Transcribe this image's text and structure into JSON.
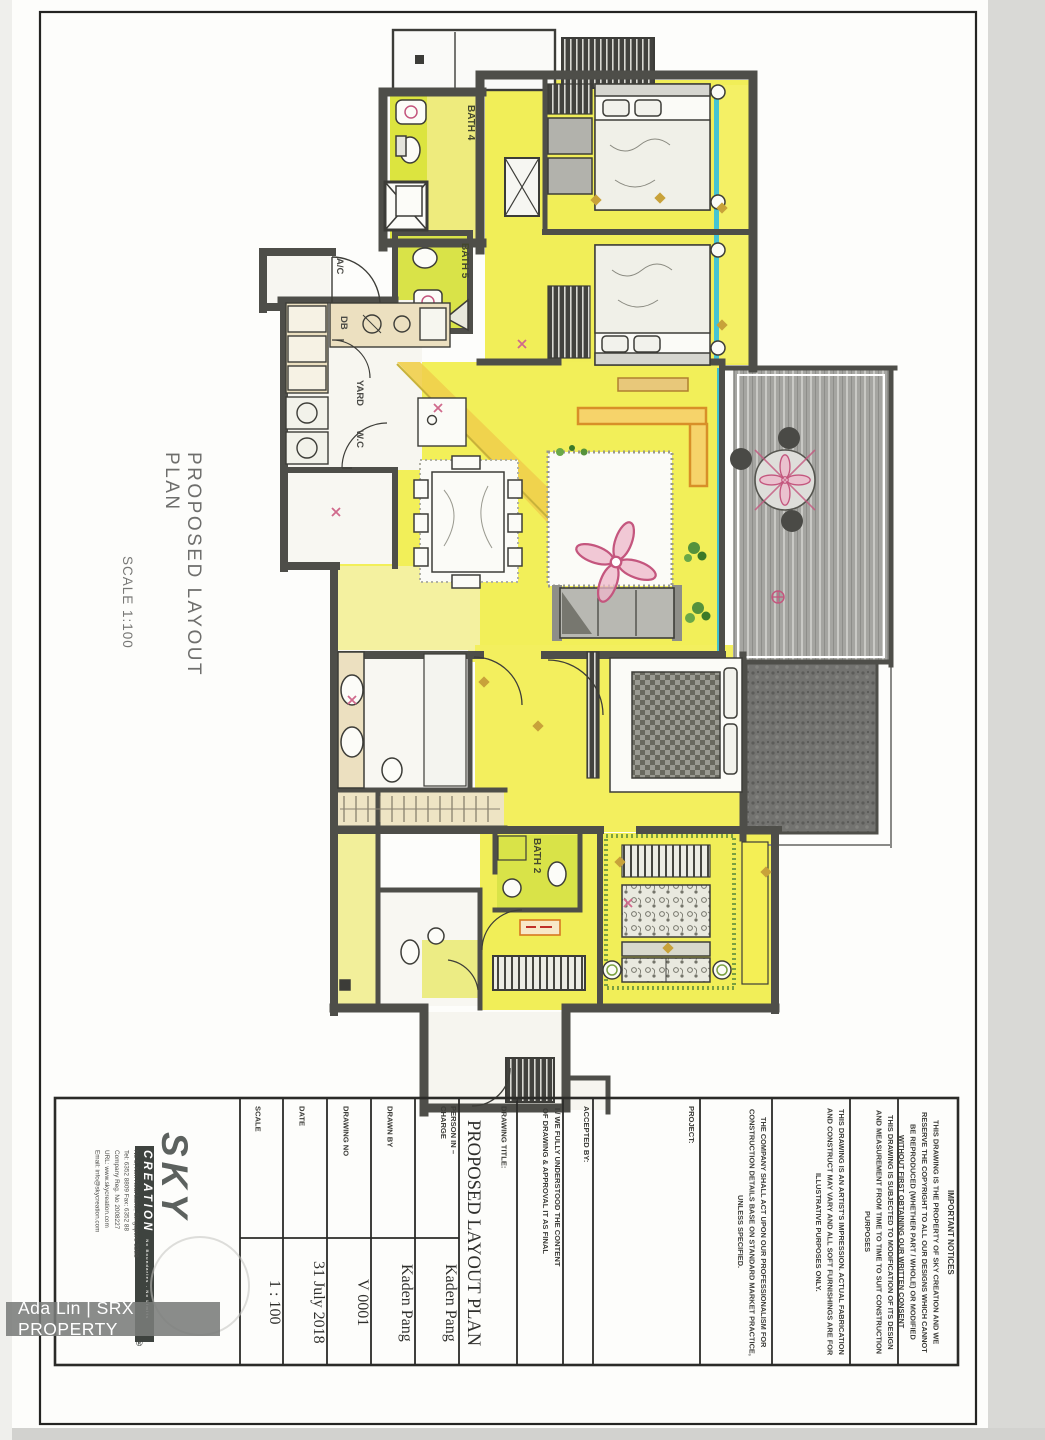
{
  "page": {
    "title": "PROPOSED LAYOUT PLAN",
    "scale_note": "SCALE 1:100"
  },
  "watermark": {
    "text": "Ada Lin | SRX PROPERTY"
  },
  "plan_labels": {
    "bath4": "BATH 4",
    "bath5": "BATH 5",
    "bath2": "BATH 2",
    "ac": "A/C",
    "db": "DB",
    "yard": "YARD",
    "wc": "W.C"
  },
  "title_block": {
    "logo": {
      "brand": "SKY",
      "brand_sub": "CREATION",
      "tagline": "No Boundaries . No Limits",
      "reg": "®",
      "addr1": "No 8, Kim Keat Lane, Singapore 3288",
      "addr2": "Tel: 6352 8809  Fax: 6352 88",
      "addr3": "Company Reg. No 2008227",
      "addr4": "URL: www.skycreation.com",
      "addr5": "Email: info@skycreation.com"
    },
    "fields": [
      {
        "label": "SCALE",
        "value": "1 : 100"
      },
      {
        "label": "DATE",
        "value": "31 July 2018"
      },
      {
        "label": "DRAWING NO",
        "value": "V 0001"
      },
      {
        "label": "DRAWN BY",
        "value": "Kaden Pang"
      },
      {
        "label": "PERSON IN – CHARGE",
        "value": "Kaden Pang"
      }
    ],
    "drawing_title_label": "DRAWING TITLE:",
    "drawing_title": "PROPOSED LAYOUT PLAN",
    "declaration": "I / WE FULLY UNDERSTOOD THE CONTENT OF DRAWING & APPROVAL IT AS FINAL",
    "accepted_by": "ACCEPTED BY:",
    "project": "PROJECT:",
    "notes": {
      "company": "THE COMPANY SHALL ACT UPON OUR PROFESSIONALISM FOR CONSTRUCTION DETAILS BASE ON STANDARD MARKET PRACTICE, UNLESS SPECIFIED.",
      "artist": "THIS DRAWING IS AN ARTIST'S IMPRESSION. ACTUAL FABRICATION AND CONSTRUCT MAY VARY AND ALL SOFT FURNISHINGS ARE FOR ILLUSTRATIVE PURPOSES ONLY.",
      "modification": "THIS DRAWING IS SUBJECTED TO MODIFICATION OF ITS DESIGN AND MEASUREMENT FROM TIME TO TIME TO SUIT CONSTRUCTION PURPOSES",
      "important_title": "IMPORTANT NOTICES",
      "important_body": "THIS DRAWING IS THE PROPERTY OF SKY CREATION AND WE RESERVE THE COPYRIGHT TO ALL OUR DESIGNS WHICH CANNOT BE REPRODUCED (WHETHER PART / WHOLE) OR MODIFIED WITHOUT FIRST OBTAINING OUR WRITTEN CONSENT"
    }
  }
}
